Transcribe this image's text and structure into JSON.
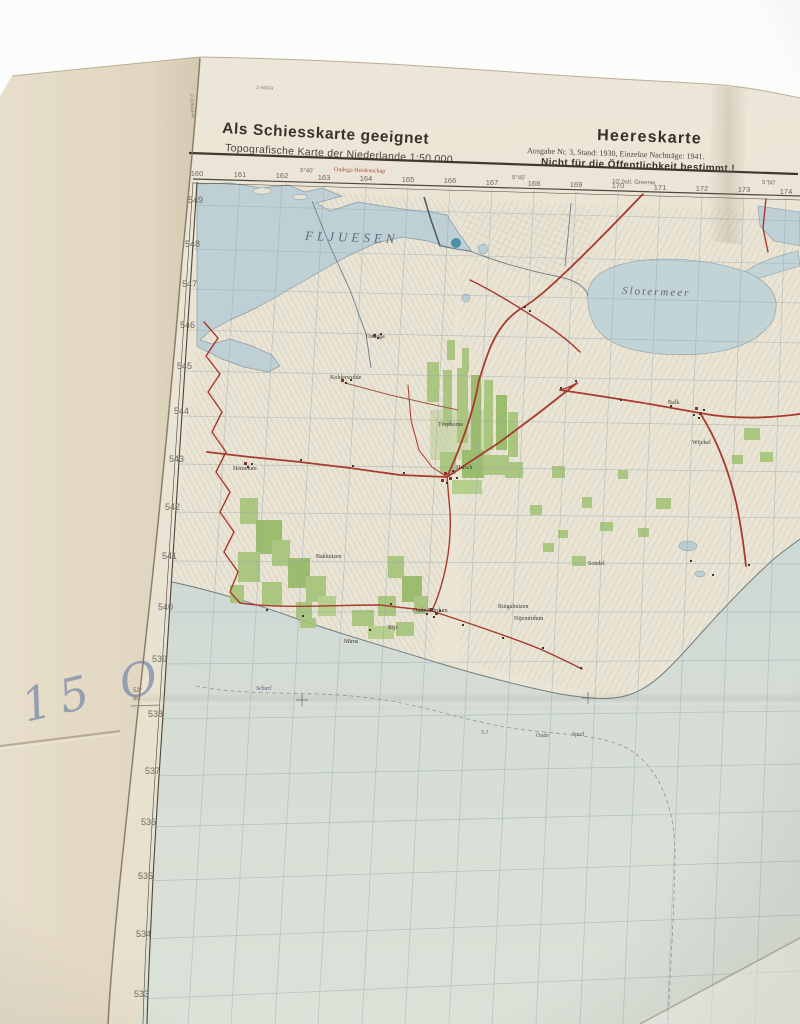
{
  "header": {
    "left_title": "Als Schiesskarte geeignet",
    "left_subtitle": "Topografische Karte der Niederlande 1:50 000",
    "right_title": "Heereskarte",
    "right_edition": "Ausgabe Nr. 3, Stand: 1930, Einzelne Nachträge: 1941.",
    "right_restriction": "Nicht für die Öffentlichkeit bestimmt !"
  },
  "marginalia": {
    "handwriting": "15 O",
    "lat_deg": "52°",
    "lat_min": "50'",
    "lon_a": "5°40'",
    "lon_b": "5°45'",
    "lon_c": "5°50'",
    "lon_note": "10' östl. Greenw.",
    "red_note": "Oudega  Heidenschap",
    "print_code_top": "Z-606/a",
    "print_code_side": "2-606/a/44"
  },
  "grid": {
    "top": [
      "160",
      "161",
      "162",
      "163",
      "164",
      "165",
      "166",
      "167",
      "168",
      "169",
      "170",
      "171",
      "172",
      "173",
      "174"
    ],
    "left": [
      "549",
      "548",
      "547",
      "546",
      "545",
      "544",
      "543",
      "542",
      "541",
      "540",
      "539",
      "538",
      "537",
      "536",
      "535",
      "534",
      "533"
    ]
  },
  "map": {
    "water_labels": {
      "fluessen": "FLJUESEN",
      "slotermeer": "Slotermeer"
    },
    "places": {
      "oudega": "Oudega",
      "kolderwolde": "Kolderwolde",
      "trophorne": "Trophorne",
      "hemelum": "Hemelum",
      "harich": "Harich",
      "balk": "Balk",
      "wijckel": "Wijckel",
      "sondel": "Sondel",
      "bakhuizen": "Bakhuizen",
      "ruigahuizen": "Ruigahuizen",
      "nijemirdum": "Nijemirdum",
      "oudemirdum": "Oude-Mirdum",
      "mirns": "Mirns",
      "rijs": "Rijs",
      "scharl": "Scharl"
    },
    "sea_marks": {
      "depth": "5.1",
      "oude": "Oude",
      "spoil": "Spoil"
    }
  },
  "colors": {
    "paper": "#e9e3d4",
    "lake_water": "#bed0d5",
    "sea_water": "#d6ded4",
    "forest": "#a3c376",
    "road_red": "#a83a2e",
    "handwriting_ink": "#8390ad"
  }
}
